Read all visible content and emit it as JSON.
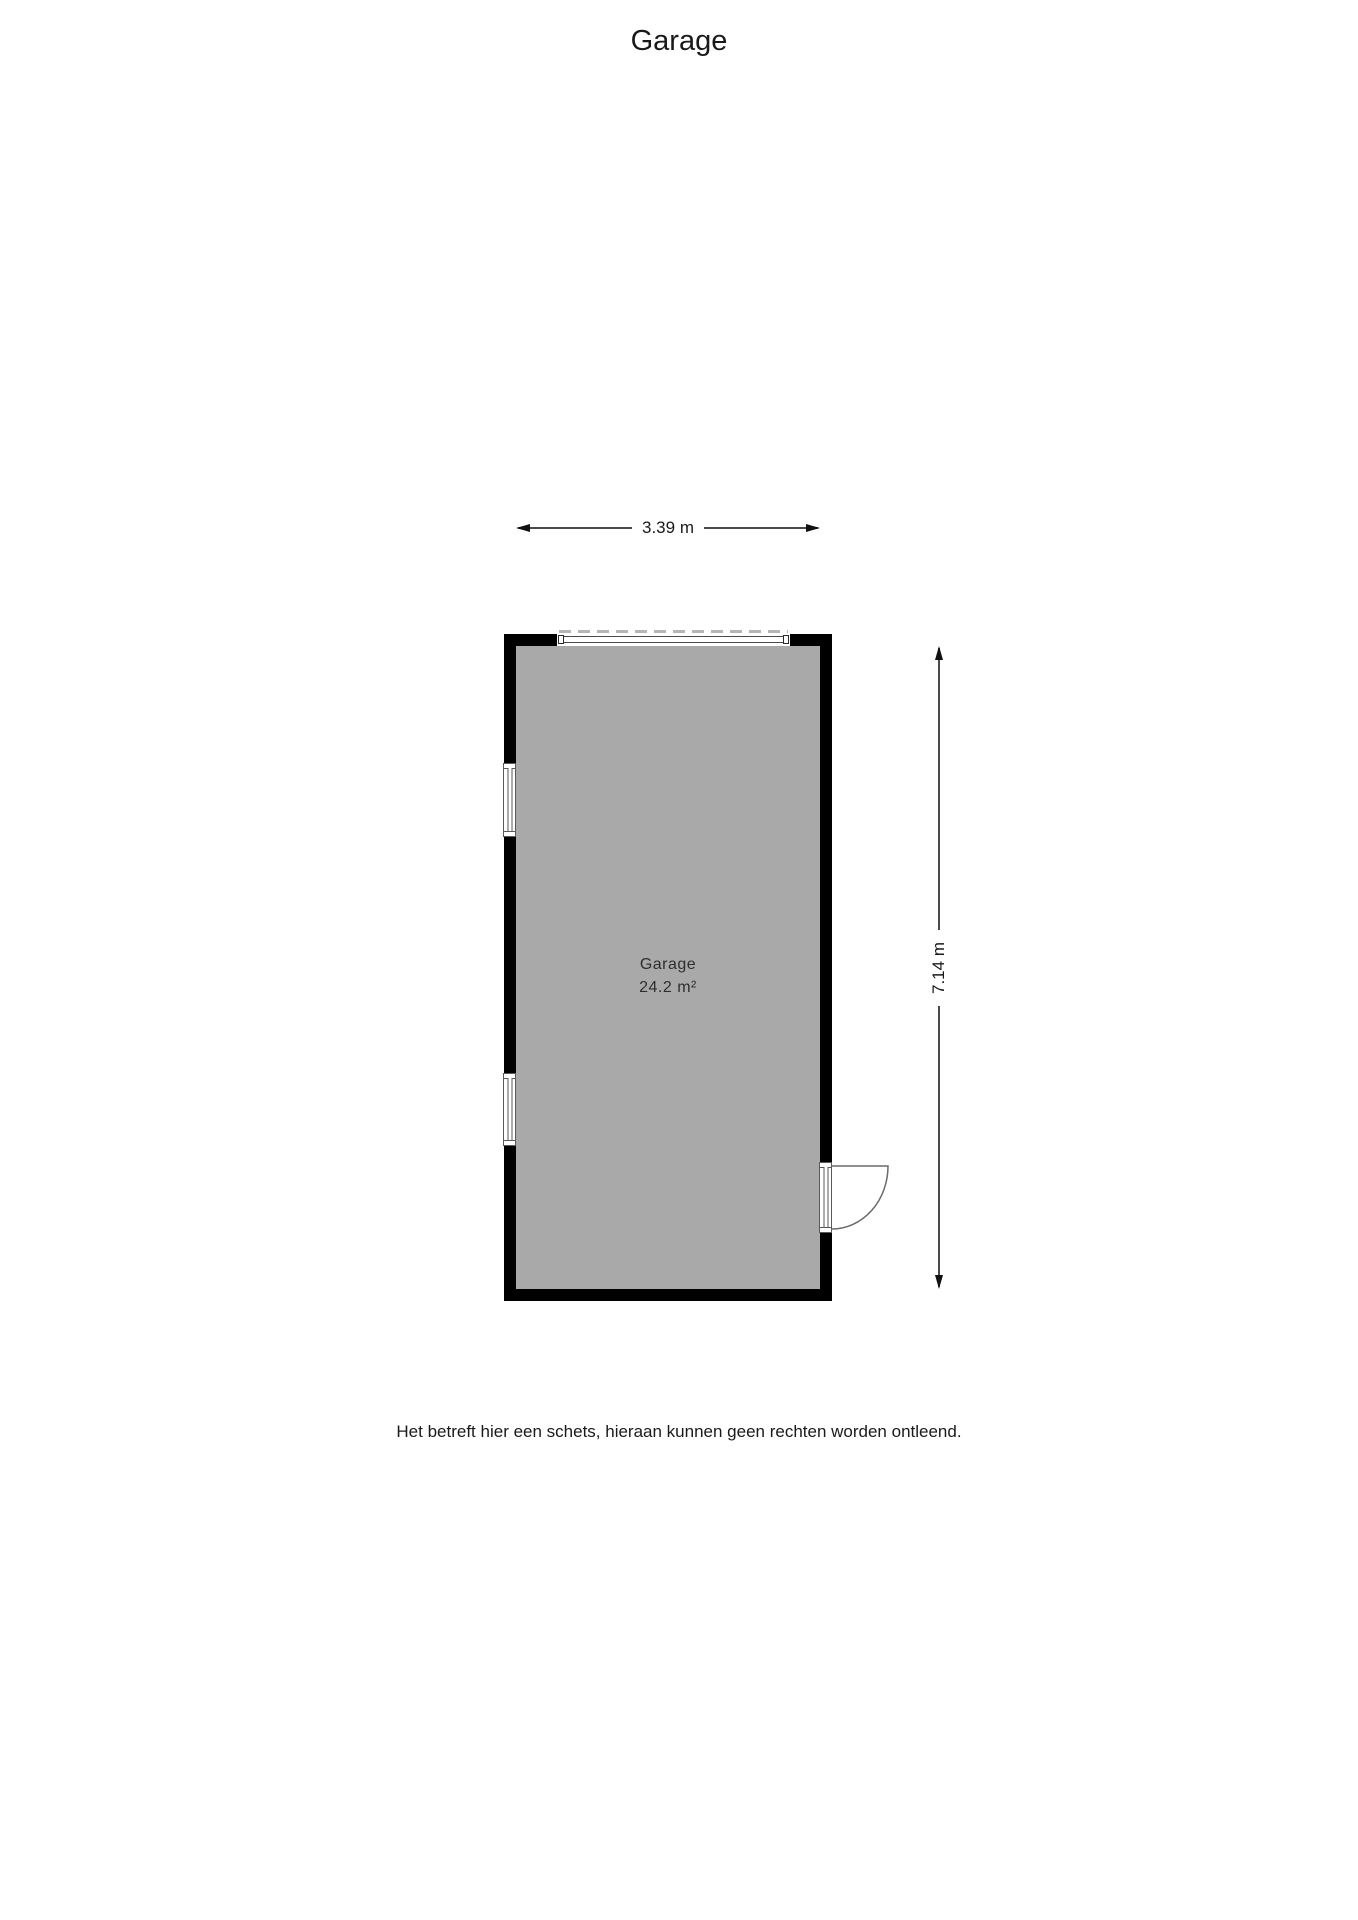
{
  "page": {
    "title": "Garage",
    "disclaimer": "Het betreft hier een schets, hieraan kunnen geen rechten worden ontleend."
  },
  "floorplan": {
    "room": {
      "name": "Garage",
      "area": "24.2 m²"
    },
    "dimensions": {
      "width_label": "3.39 m",
      "height_label": "7.14 m"
    },
    "features": [
      "garage-door-top-wall",
      "window-left-upper",
      "window-left-lower",
      "swing-door-right-wall"
    ],
    "colors": {
      "wall": "#000000",
      "floor": "#a9a9a9",
      "dimension_line": "#4a4a4a",
      "door_dash": "#b5b5b5",
      "text": "#1a1a1a"
    }
  }
}
